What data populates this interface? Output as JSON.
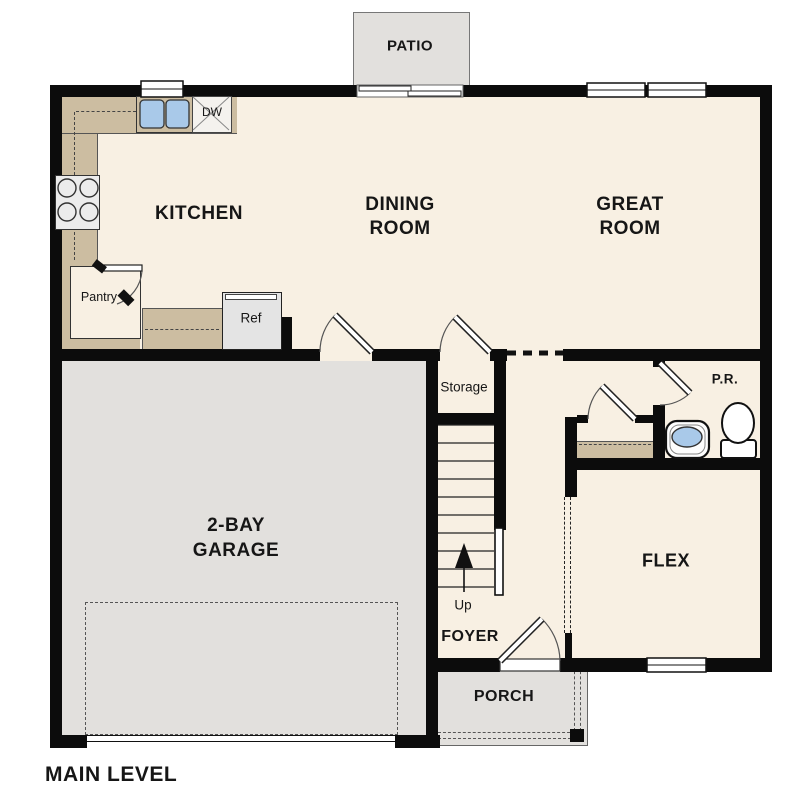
{
  "plan": {
    "title": "MAIN LEVEL",
    "labels": {
      "patio": "PATIO",
      "kitchen": "KITCHEN",
      "dining_1": "DINING",
      "dining_2": "ROOM",
      "great_1": "GREAT",
      "great_2": "ROOM",
      "pantry": "Pantry",
      "dw": "DW",
      "ref": "Ref",
      "storage": "Storage",
      "garage_1": "2-BAY",
      "garage_2": "GARAGE",
      "up": "Up",
      "foyer": "FOYER",
      "flex": "FLEX",
      "pr": "P.R.",
      "porch": "PORCH"
    },
    "colors": {
      "floor": "#f8f0e3",
      "hardscape": "#e2e0dd",
      "counter": "#ccbda1",
      "wall": "#0c0c0c",
      "sink_blue": "#a9c9e9"
    }
  }
}
